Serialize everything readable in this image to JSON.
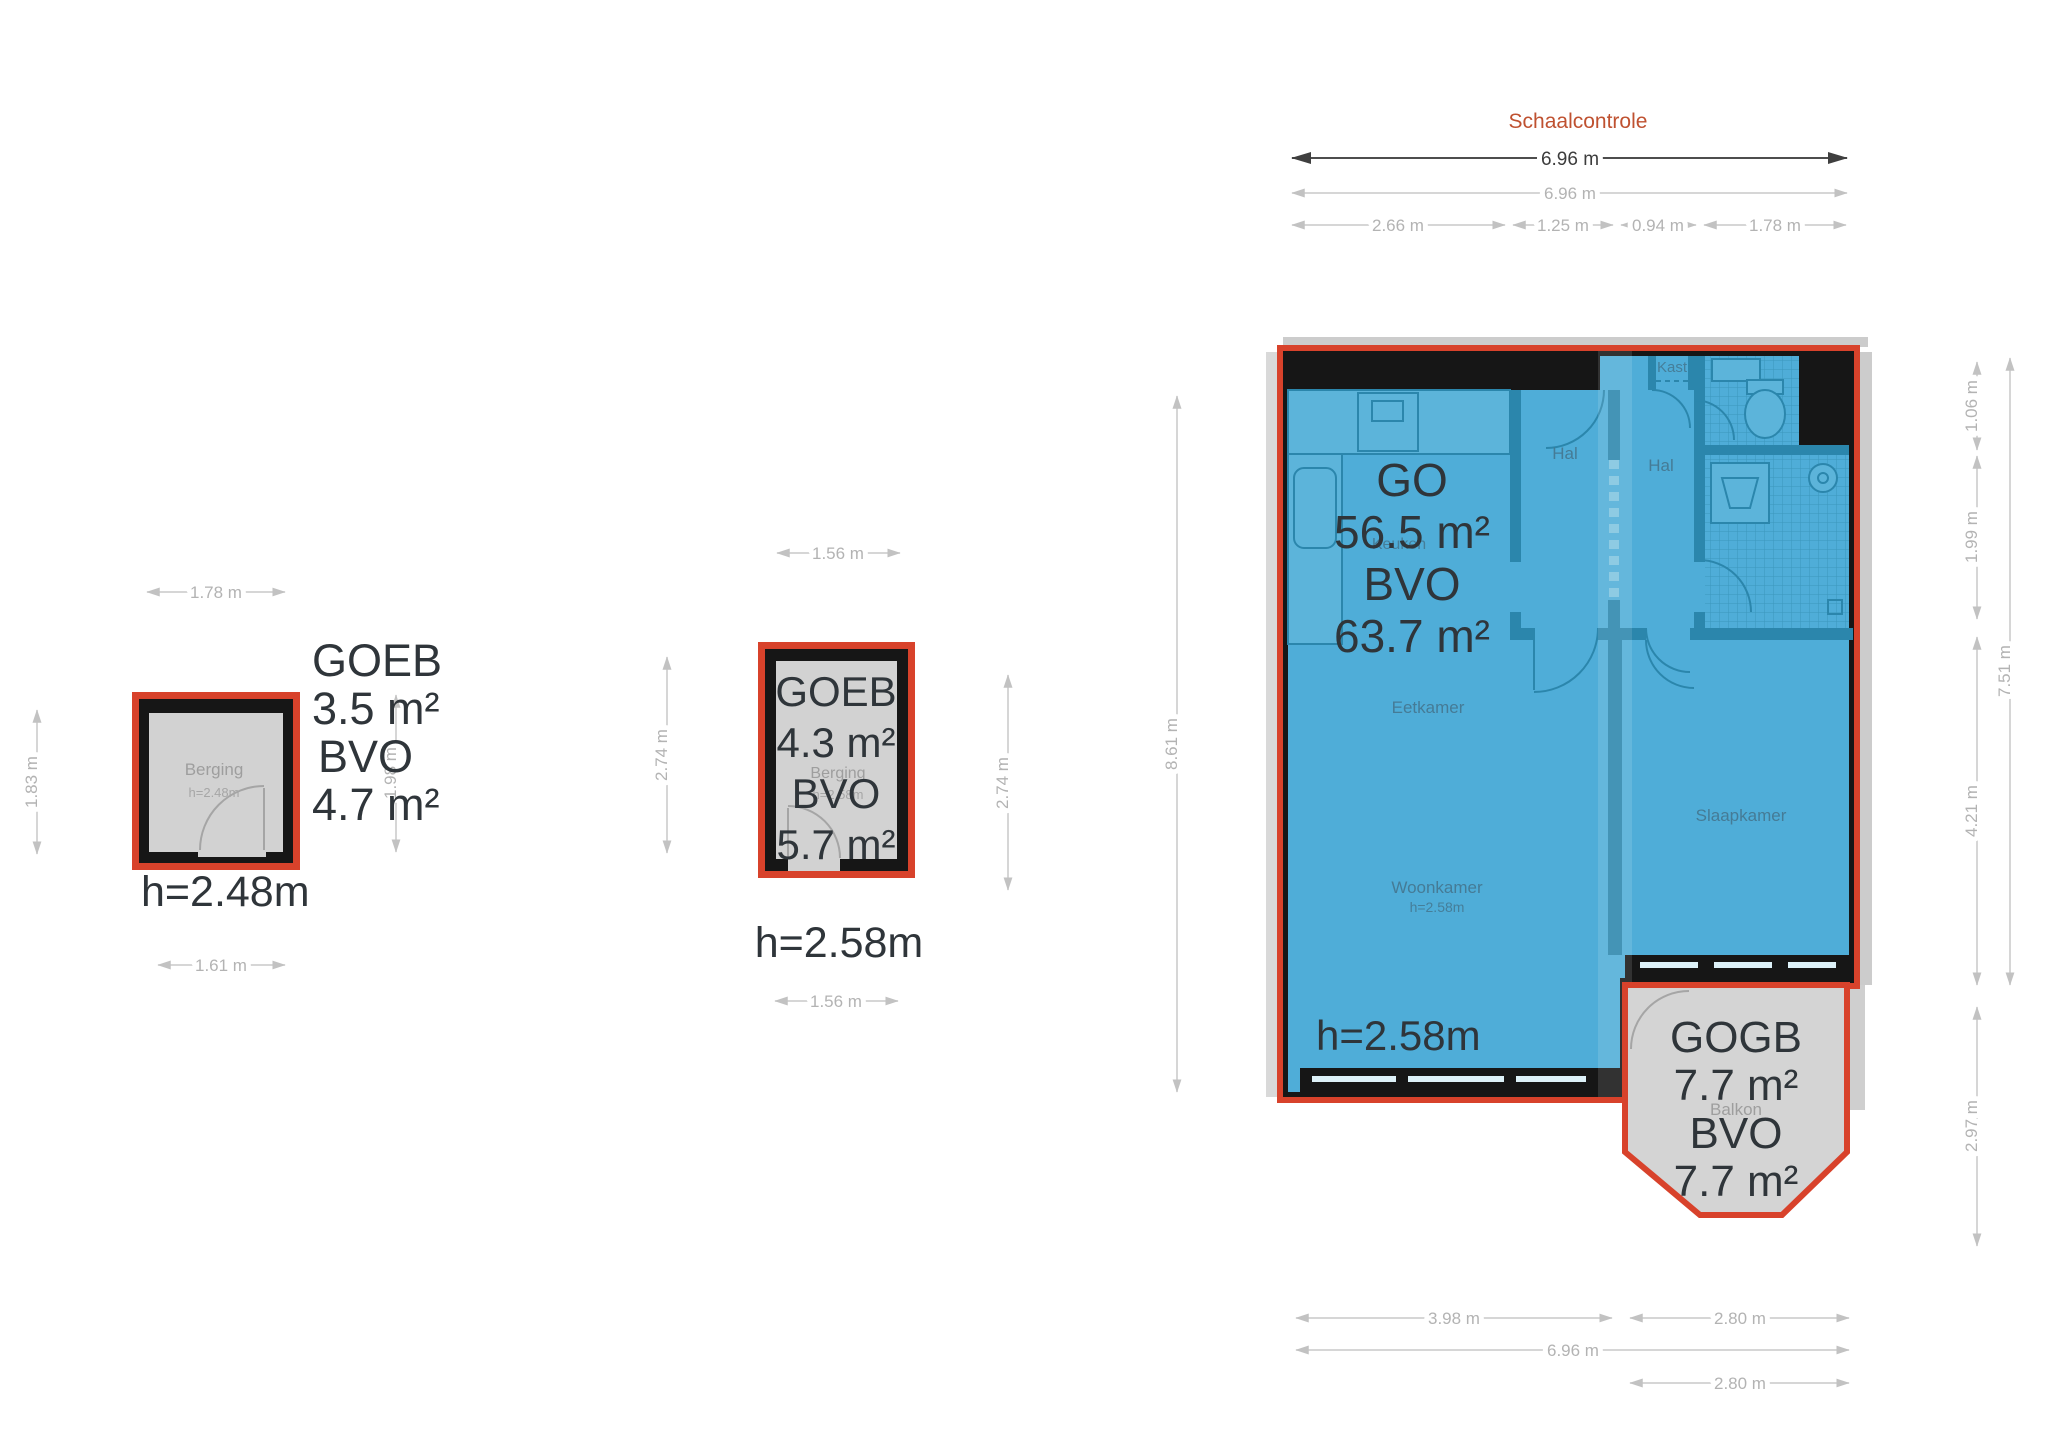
{
  "title": "Schaalcontrole",
  "colors": {
    "accent_red": "#d8422b",
    "plan_blue": "#4fadd8",
    "wall_blue": "#2b86ac",
    "wall_black": "#161616",
    "gray_fill": "#d2d2d2",
    "dim_gray": "#b3b3b3",
    "dim_dark": "#3c3c3c",
    "big_text": "#2f353a",
    "title_color": "#bf5130"
  },
  "berging_plan": {
    "area_label": "GOEB",
    "area_value": "3.5 m²",
    "gross_label": "BVO",
    "gross_value": "4.7 m²",
    "ceiling_height": "h=2.48m",
    "room_name": "Berging",
    "room_height": "h=2.48m",
    "dim_top": "1.78 m",
    "dim_left": "1.83 m",
    "dim_right": "1.98 m",
    "dim_bottom": "1.61 m"
  },
  "goeb_plan": {
    "area_label": "GOEB",
    "area_value": "4.3 m²",
    "gross_label": "BVO",
    "gross_value": "5.7 m²",
    "ceiling_height": "h=2.58m",
    "room_name": "Berging",
    "room_height": "h=2.58m",
    "dim_top": "1.56 m",
    "dim_left": "2.74 m",
    "dim_right": "2.74 m",
    "dim_bottom": "1.56 m"
  },
  "apartment_plan": {
    "area_label": "GO",
    "area_value": "56.5 m²",
    "gross_label": "BVO",
    "gross_value": "63.7 m²",
    "ceiling_height": "h=2.58m",
    "rooms": {
      "kitchen": "Keuken",
      "hall1": "Hal",
      "hall2": "Hal",
      "closet": "Kast",
      "dining": "Eetkamer",
      "living": "Woonkamer",
      "living_height": "h=2.58m",
      "bedroom": "Slaapkamer"
    },
    "dims": {
      "top_total": "6.96 m",
      "top_total2": "6.96 m",
      "top_seg1": "2.66 m",
      "top_seg2": "1.25 m",
      "top_seg3": "0.94 m",
      "top_seg4": "1.78 m",
      "left": "8.61 m",
      "right_seg1": "1.06 m",
      "right_seg2": "1.99 m",
      "right_seg3": "4.21 m",
      "right_seg4": "2.97 m",
      "right_total": "7.51 m",
      "bottom_seg1": "3.98 m",
      "bottom_seg2": "2.80 m",
      "bottom_total": "6.96 m",
      "bottom_balcony": "2.80 m"
    }
  },
  "balcony": {
    "area_label": "GOGB",
    "area_value": "7.7 m²",
    "gross_label": "BVO",
    "gross_value": "7.7 m²",
    "room_name": "Balkon"
  }
}
